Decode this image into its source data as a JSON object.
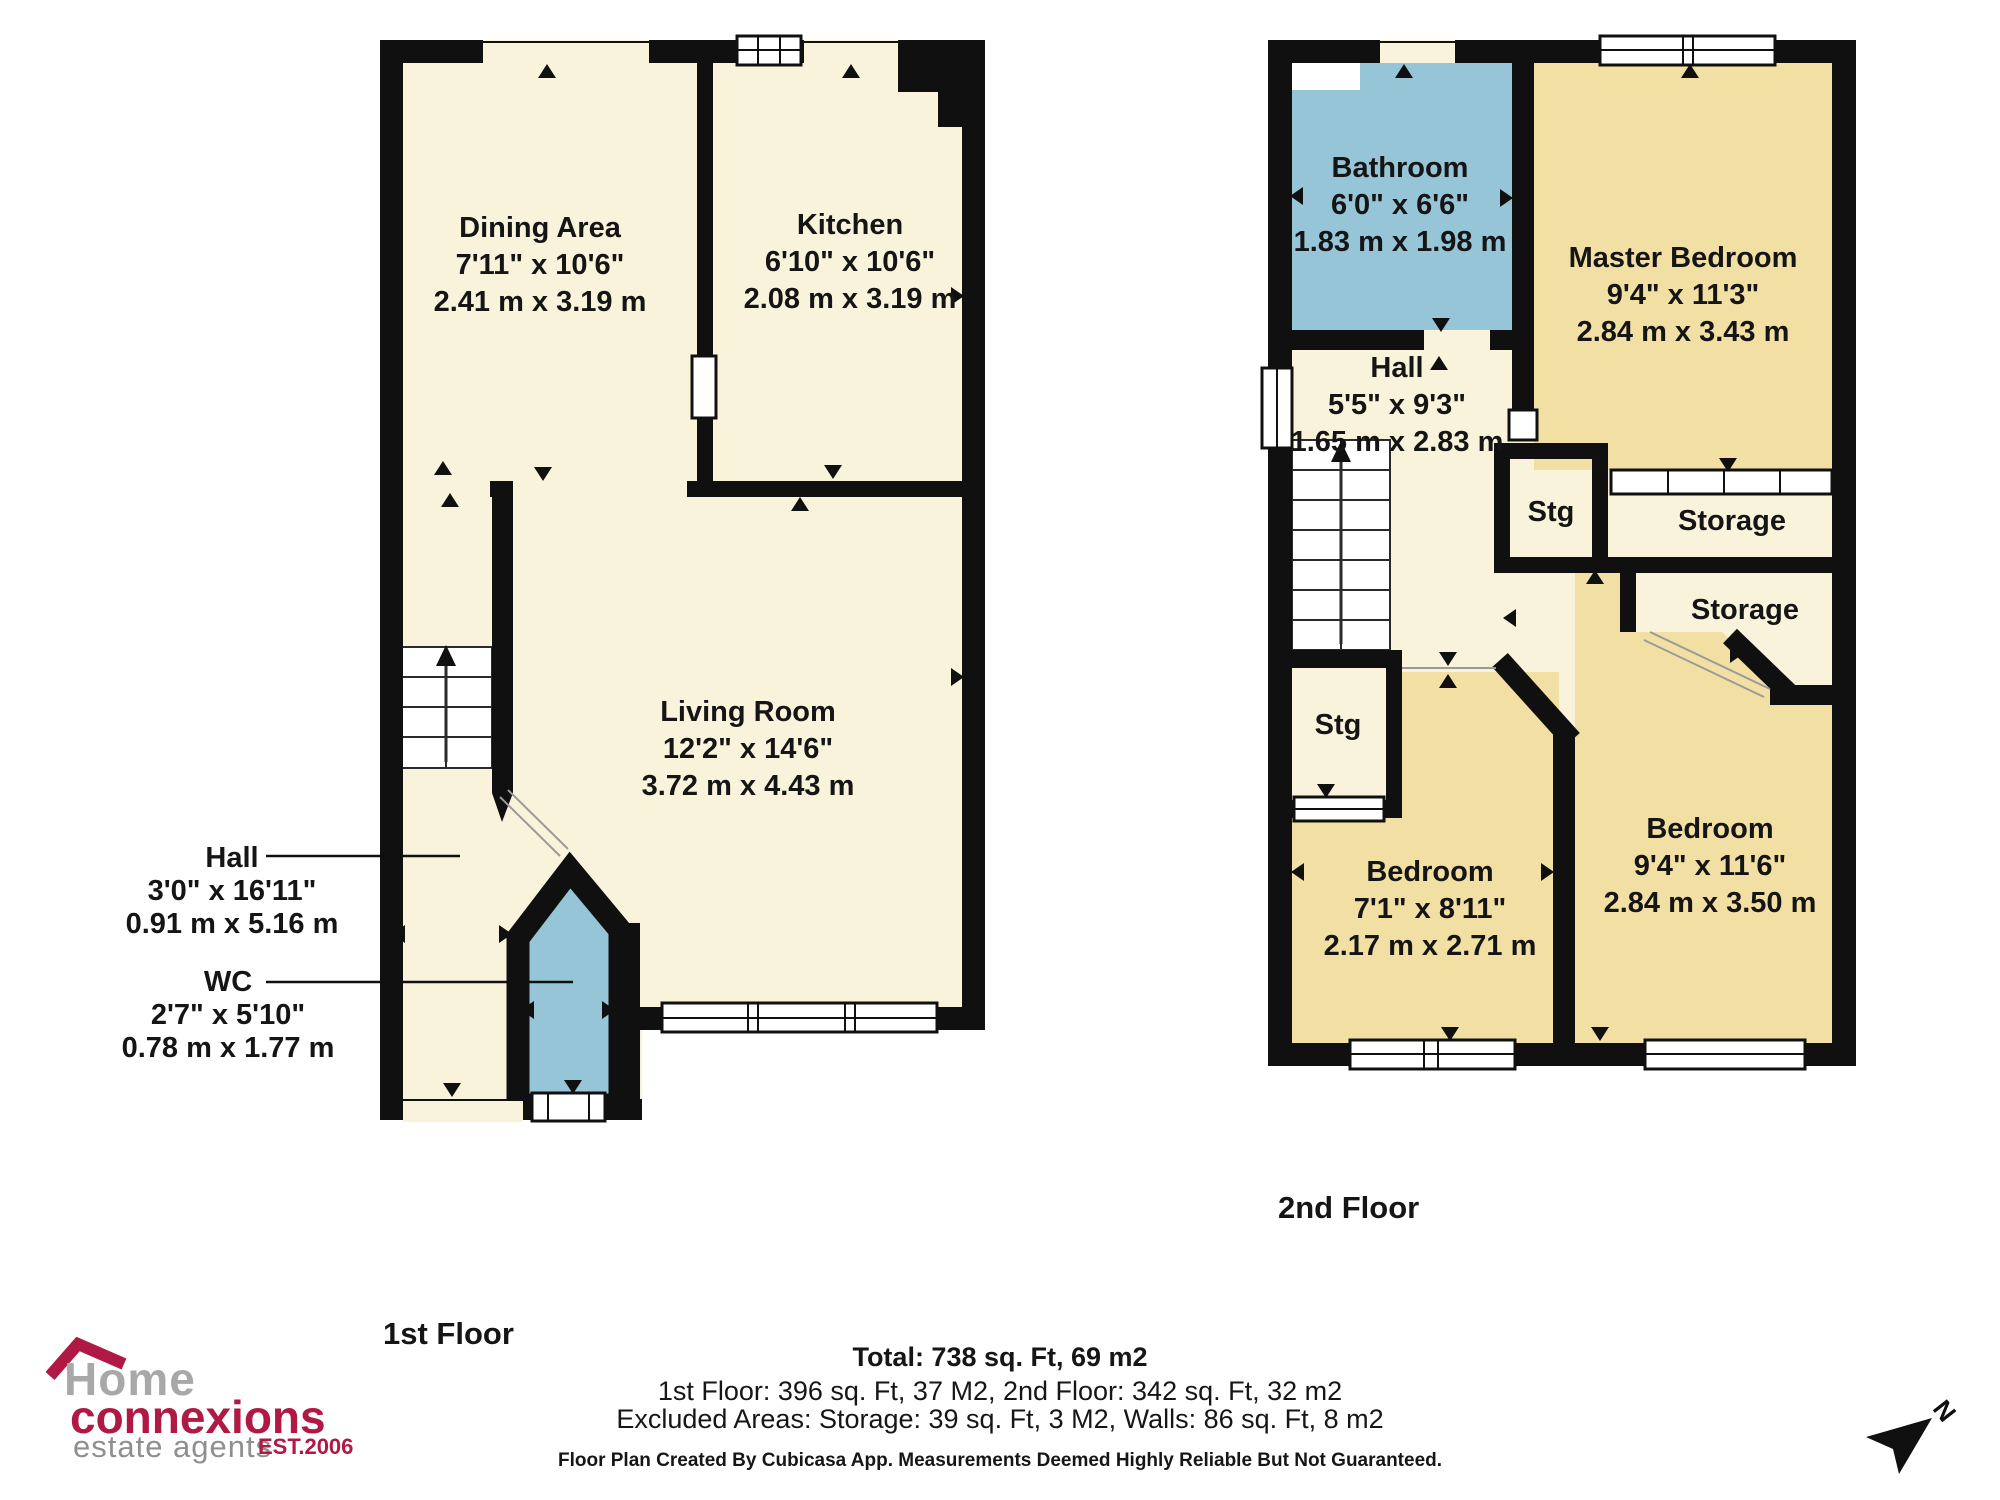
{
  "floor1": {
    "title": "1st Floor",
    "rooms": {
      "dining": {
        "name": "Dining Area",
        "imperial": "7'11\" x 10'6\"",
        "metric": "2.41 m x 3.19 m"
      },
      "kitchen": {
        "name": "Kitchen",
        "imperial": "6'10\" x 10'6\"",
        "metric": "2.08 m x 3.19 m"
      },
      "living": {
        "name": "Living Room",
        "imperial": "12'2\" x 14'6\"",
        "metric": "3.72 m x 4.43 m"
      },
      "hall": {
        "name": "Hall",
        "imperial": "3'0\" x 16'11\"",
        "metric": "0.91 m x 5.16 m"
      },
      "wc": {
        "name": "WC",
        "imperial": "2'7\" x 5'10\"",
        "metric": "0.78 m x 1.77 m"
      }
    }
  },
  "floor2": {
    "title": "2nd Floor",
    "rooms": {
      "bathroom": {
        "name": "Bathroom",
        "imperial": "6'0\" x 6'6\"",
        "metric": "1.83 m x 1.98 m"
      },
      "master": {
        "name": "Master Bedroom",
        "imperial": "9'4\" x 11'3\"",
        "metric": "2.84 m x 3.43 m"
      },
      "hall": {
        "name": "Hall",
        "imperial": "5'5\" x 9'3\"",
        "metric": "1.65 m x 2.83 m"
      },
      "stg_upper": {
        "name": "Stg"
      },
      "storage_upper": {
        "name": "Storage"
      },
      "storage_lower": {
        "name": "Storage"
      },
      "stg_lower": {
        "name": "Stg"
      },
      "bedroom_small": {
        "name": "Bedroom",
        "imperial": "7'1\" x 8'11\"",
        "metric": "2.17 m x 2.71 m"
      },
      "bedroom_large": {
        "name": "Bedroom",
        "imperial": "9'4\" x 11'6\"",
        "metric": "2.84 m x 3.50 m"
      }
    }
  },
  "summary": {
    "total": "Total: 738 sq. Ft, 69 m2",
    "floors": "1st Floor: 396 sq. Ft, 37 M2, 2nd Floor: 342 sq. Ft, 32 m2",
    "excluded": "Excluded Areas: Storage: 39 sq. Ft, 3 M2, Walls: 86 sq. Ft, 8 m2",
    "disclaimer": "Floor Plan Created By Cubicasa App. Measurements Deemed Highly Reliable But Not Guaranteed."
  },
  "logo": {
    "home": "Home",
    "connexions": "connexions",
    "estate": "estate agents",
    "est": "EST.2006"
  },
  "compass": {
    "label": "N"
  },
  "colors": {
    "floor_cream": "#faf3dc",
    "bedroom_tan": "#f2dfa3",
    "wet_room_blue": "#95c5d7",
    "wall_black": "#101010",
    "brand_red": "#b01943",
    "logo_gray": "#a8a8a8"
  }
}
